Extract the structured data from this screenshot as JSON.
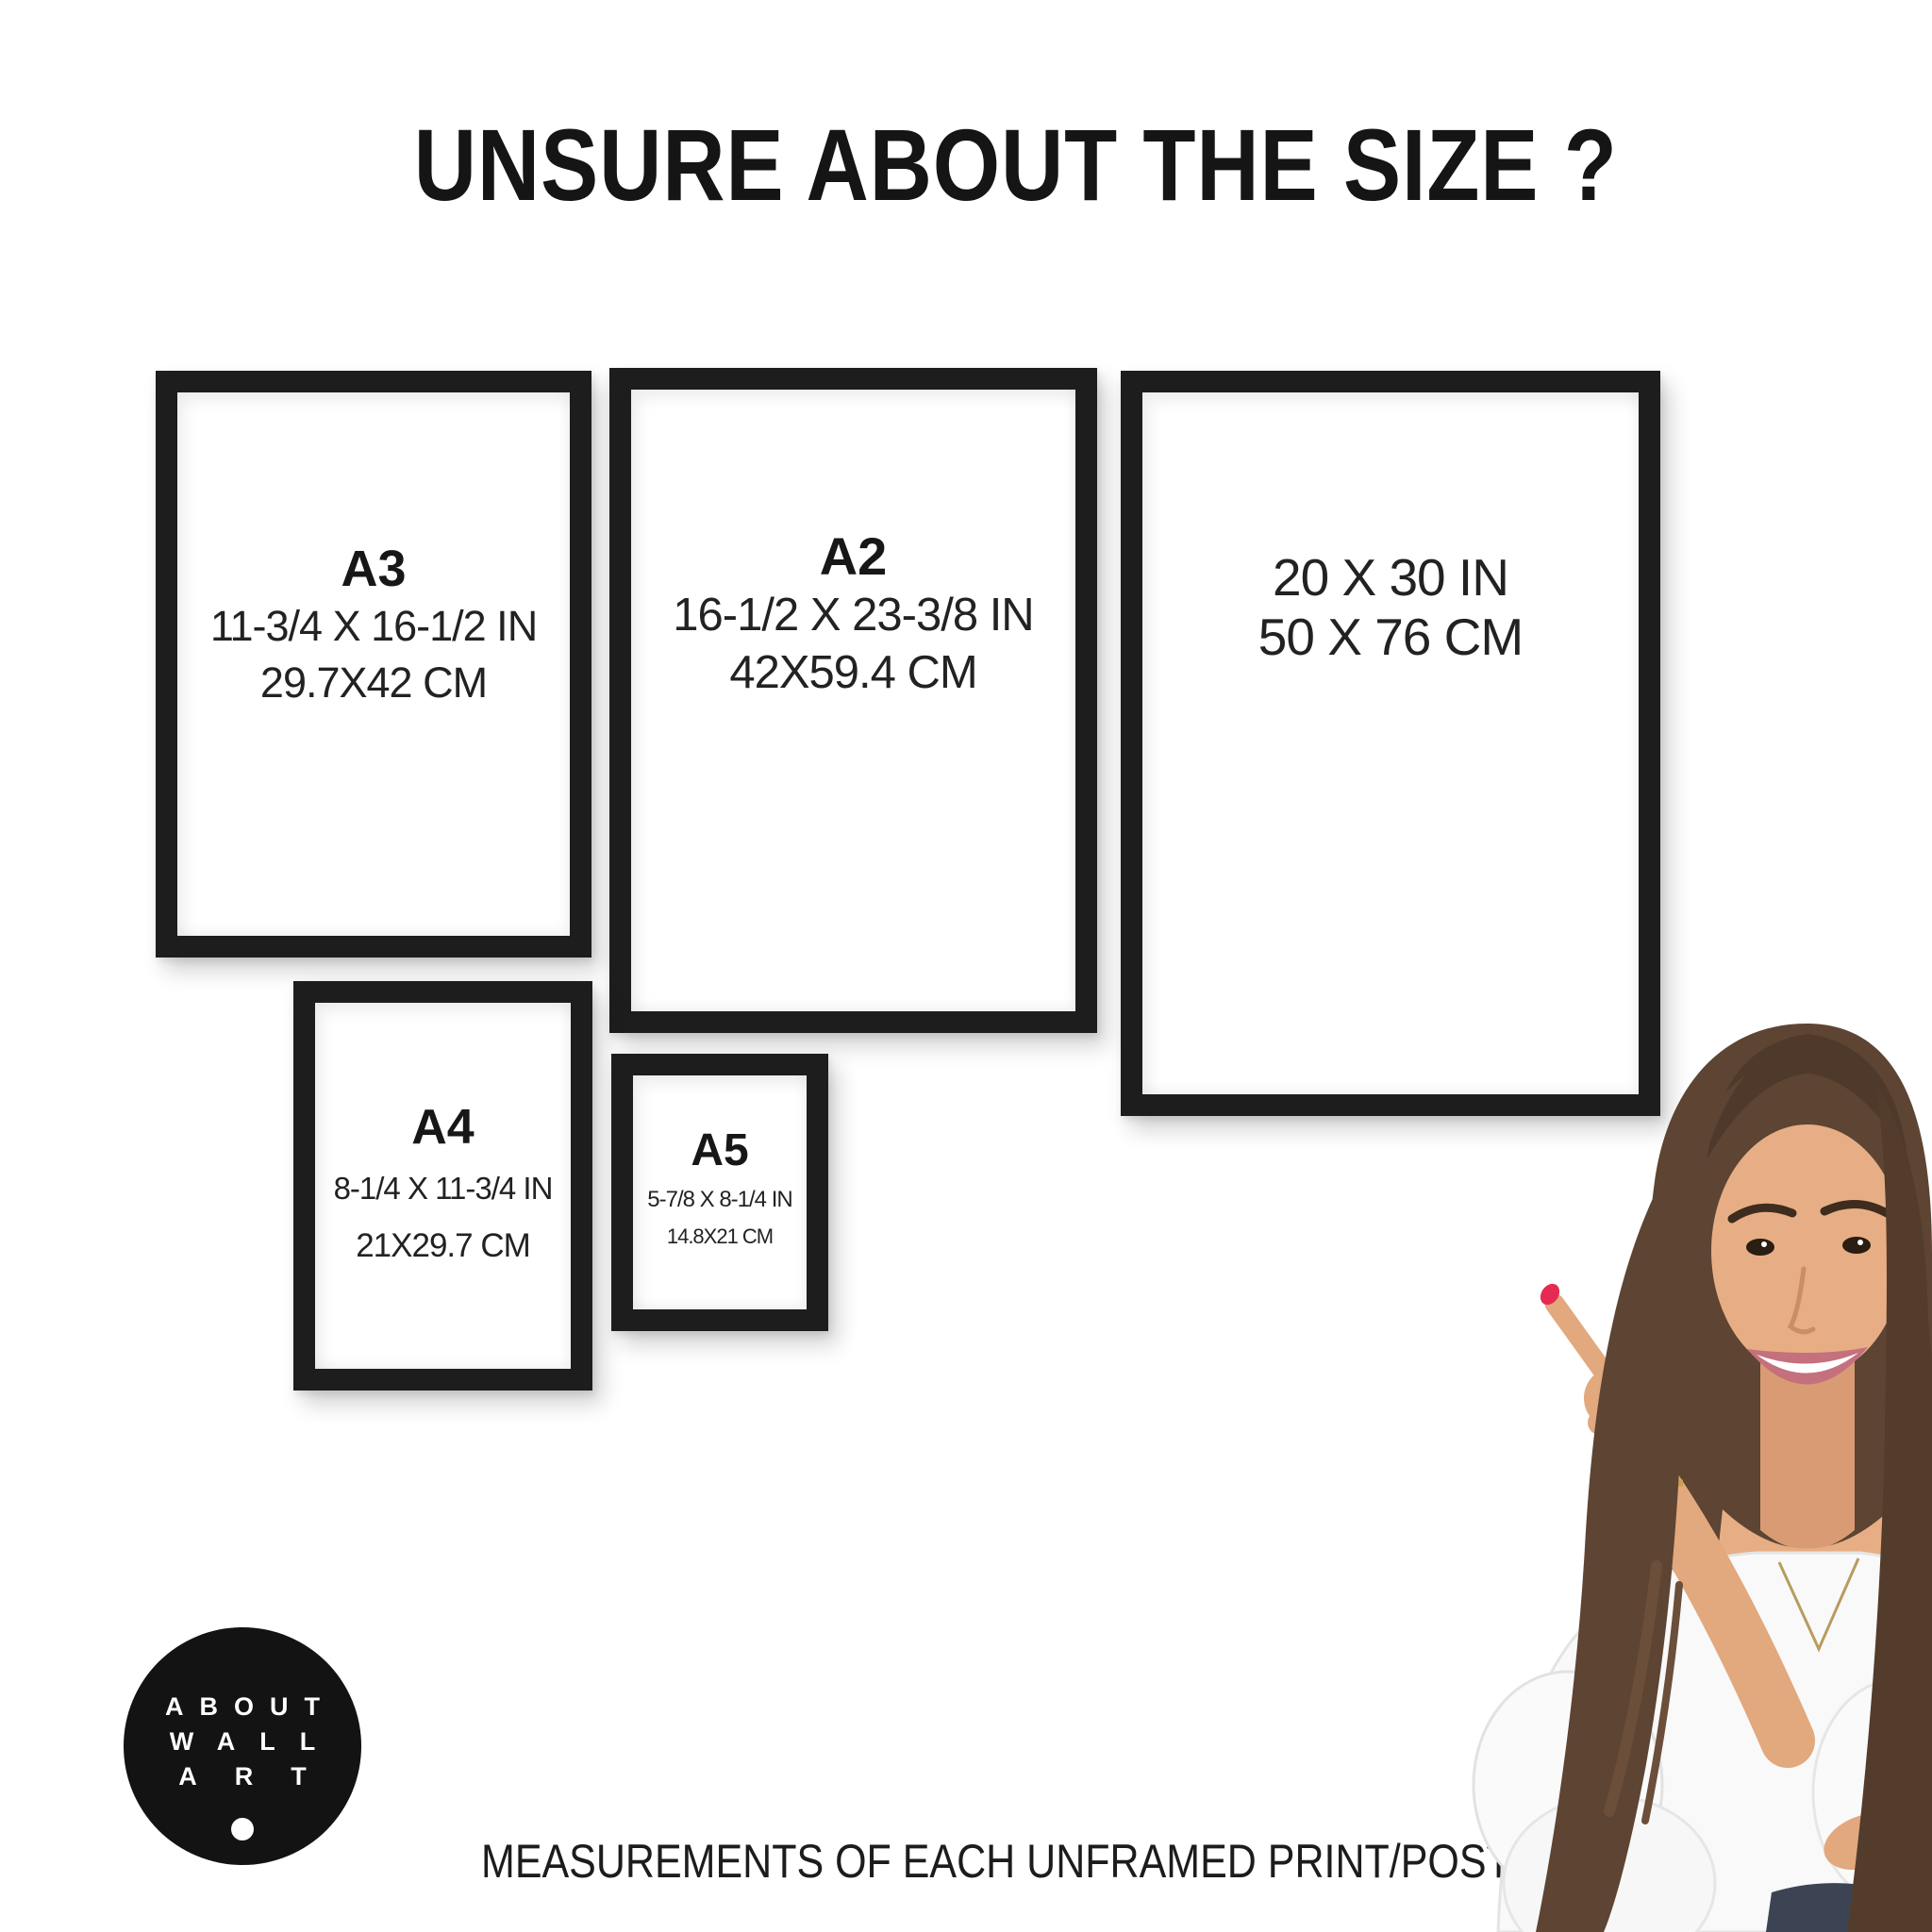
{
  "title": "UNSURE ABOUT THE SIZE ?",
  "frames": [
    {
      "name": "A3",
      "inches": "11-3/4 X 16-1/2 IN",
      "cm": "29.7X42 CM"
    },
    {
      "name": "A2",
      "inches": "16-1/2 X 23-3/8 IN",
      "cm": "42X59.4 CM"
    },
    {
      "name": "",
      "inches": "20 X 30 IN",
      "cm": "50 X 76 CM"
    },
    {
      "name": "A4",
      "inches": "8-1/4 X 11-3/4 IN",
      "cm": "21X29.7 CM"
    },
    {
      "name": "A5",
      "inches": "5-7/8 X 8-1/4 IN",
      "cm": "14.8X21 CM"
    }
  ],
  "logo": {
    "lines": [
      "ABOUT",
      "WALL",
      "ART"
    ]
  },
  "footer": "MEASUREMENTS OF EACH UNFRAMED PRINT/POSTER",
  "colors": {
    "background": "#ffffff",
    "frame_border": "#1d1d1d",
    "text": "#1e1e1e",
    "logo_circle": "#131313",
    "logo_text": "#ffffff",
    "nail_polish": "#e52b52",
    "hair": "#5d4433",
    "skin": "#e7ae85",
    "blouse": "#f9f9f9"
  }
}
